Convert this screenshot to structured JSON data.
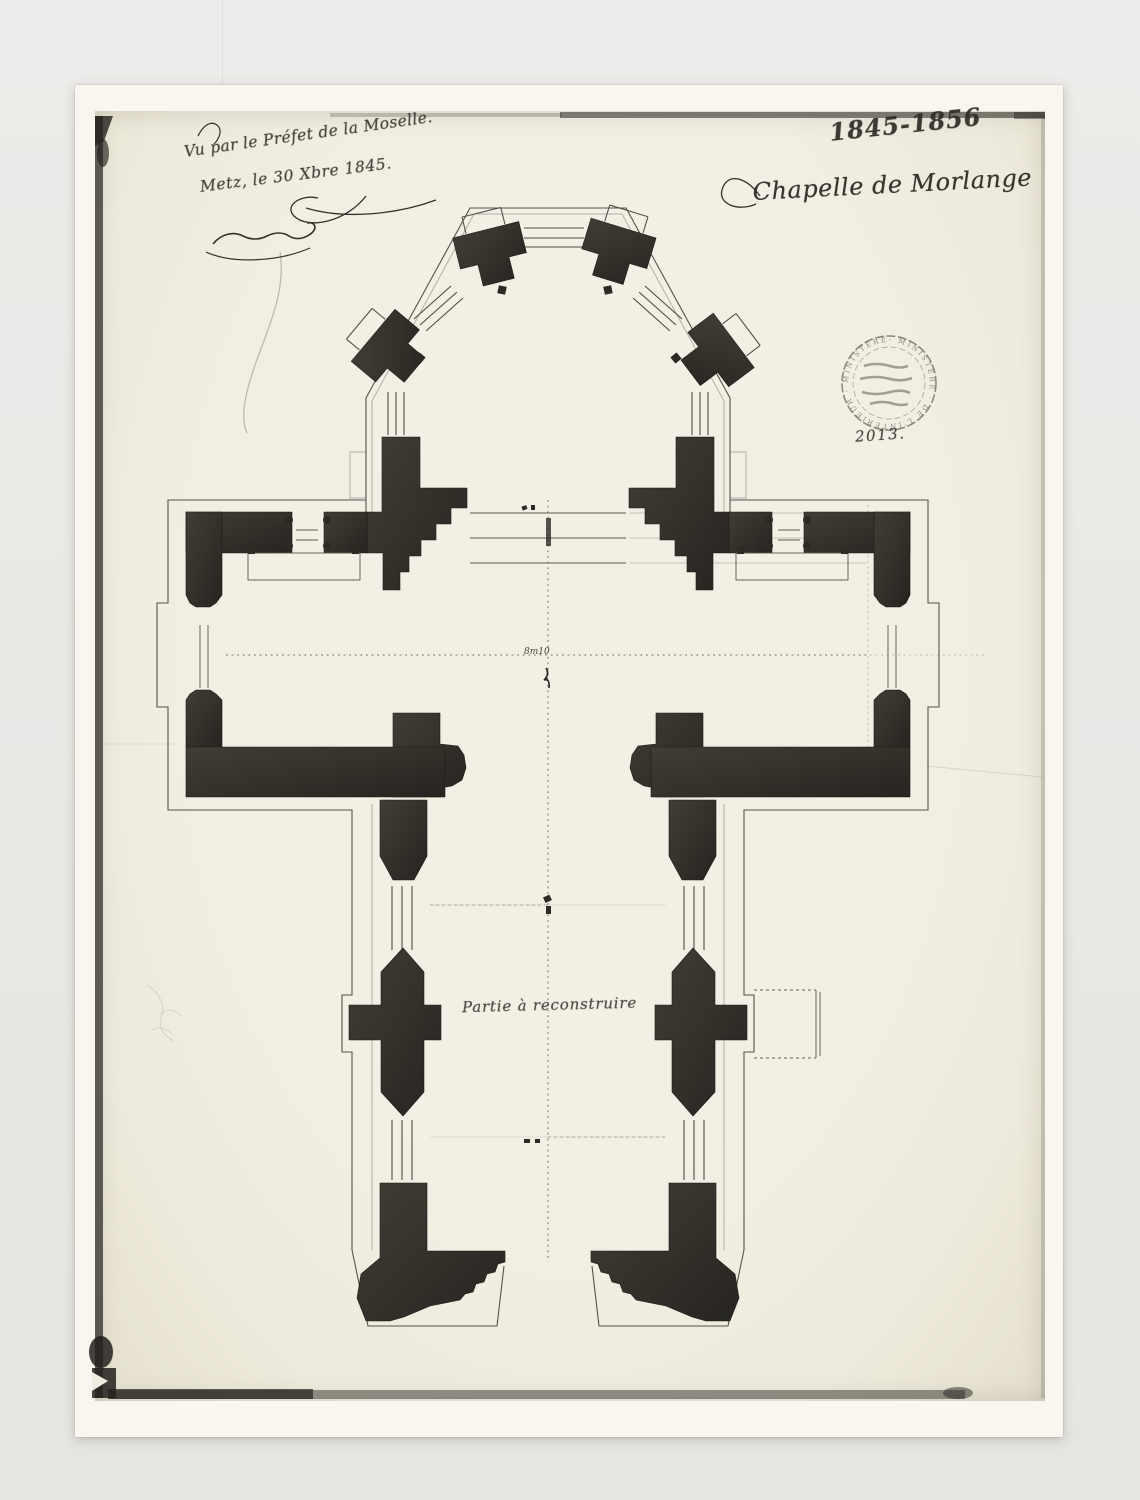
{
  "scene": {
    "background_color": "#e9e8e5",
    "paper_color": "#f8f6ef",
    "photo_color": "#f1eee2",
    "ink_color": "#2b2823"
  },
  "annotations": {
    "approval_line1": "Vu par le Préfet de la Moselle.",
    "approval_line2": "Metz, le 30 Xbre 1845.",
    "archive_number": "1845-1856",
    "title": "Chapelle de Morlange",
    "stamp_ring_text": "· MINISTÈRE · DE L'INTÉRIEUR · MINISTÈRE ·",
    "stamp_number": "2013.",
    "plan_label": "Partie à reconstruire",
    "axis_dimension": "8m10"
  }
}
